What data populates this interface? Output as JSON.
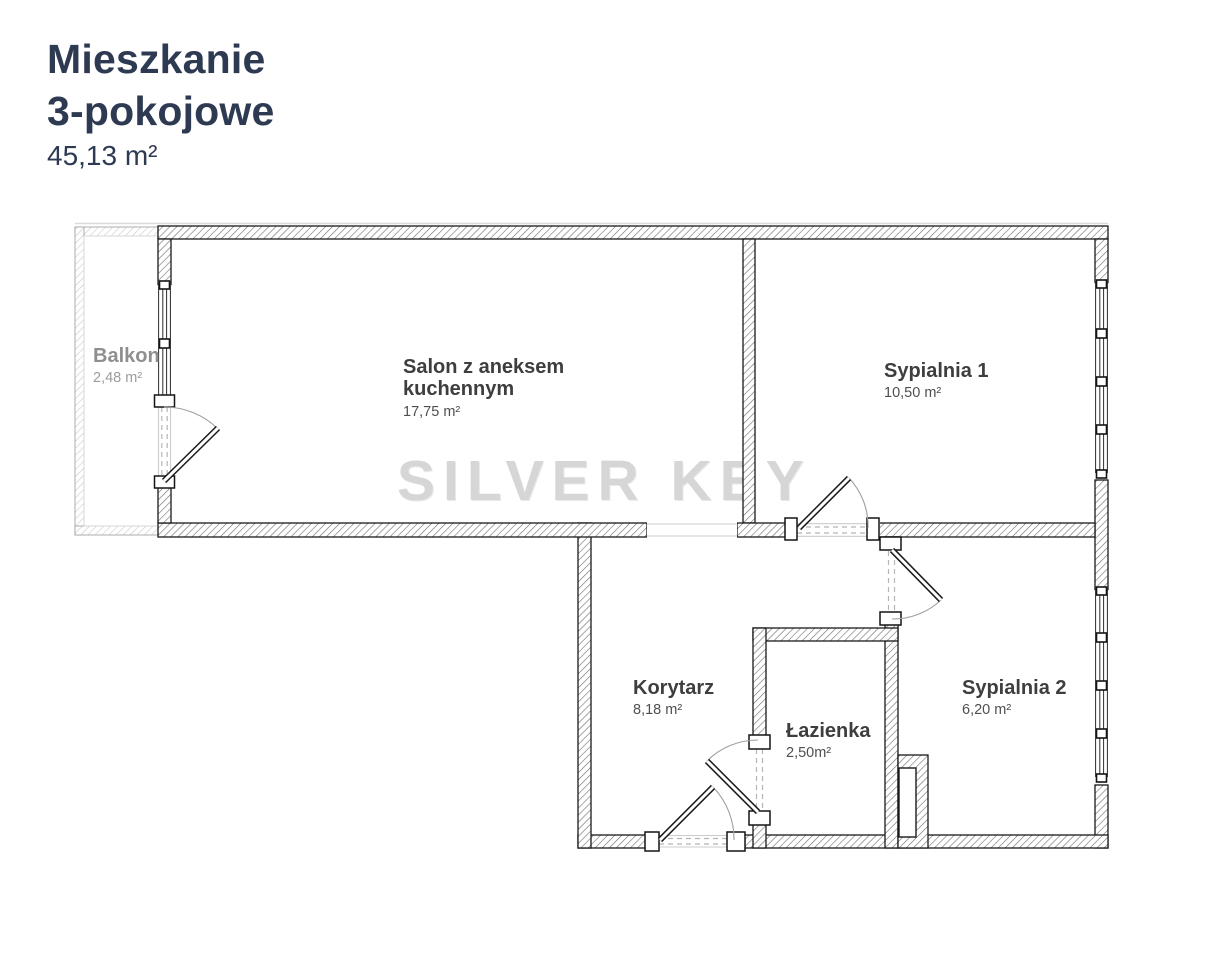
{
  "header": {
    "title_line1": "Mieszkanie",
    "title_line2": "3-pokojowe",
    "total_area": "45,13 m²"
  },
  "watermark": {
    "text": "SILVER KEY"
  },
  "rooms": {
    "balkon": {
      "name_lines": [
        "Balkon"
      ],
      "area": "2,48 m²"
    },
    "salon": {
      "name_lines": [
        "Salon z aneksem",
        "kuchennym"
      ],
      "area": "17,75 m²"
    },
    "sypialnia1": {
      "name_lines": [
        "Sypialnia 1"
      ],
      "area": "10,50 m²"
    },
    "korytarz": {
      "name_lines": [
        "Korytarz"
      ],
      "area": "8,18 m²"
    },
    "lazienka": {
      "name_lines": [
        "Łazienka"
      ],
      "area": "2,50m²"
    },
    "sypialnia2": {
      "name_lines": [
        "Sypialnia 2"
      ],
      "area": "6,20 m²"
    }
  },
  "colors": {
    "title": "#2d3a52",
    "room_label": "#3e3e3e",
    "muted_label": "#8f8f8f",
    "watermark": "#d6d6d6",
    "wall_outline": "#1a1a1a"
  }
}
